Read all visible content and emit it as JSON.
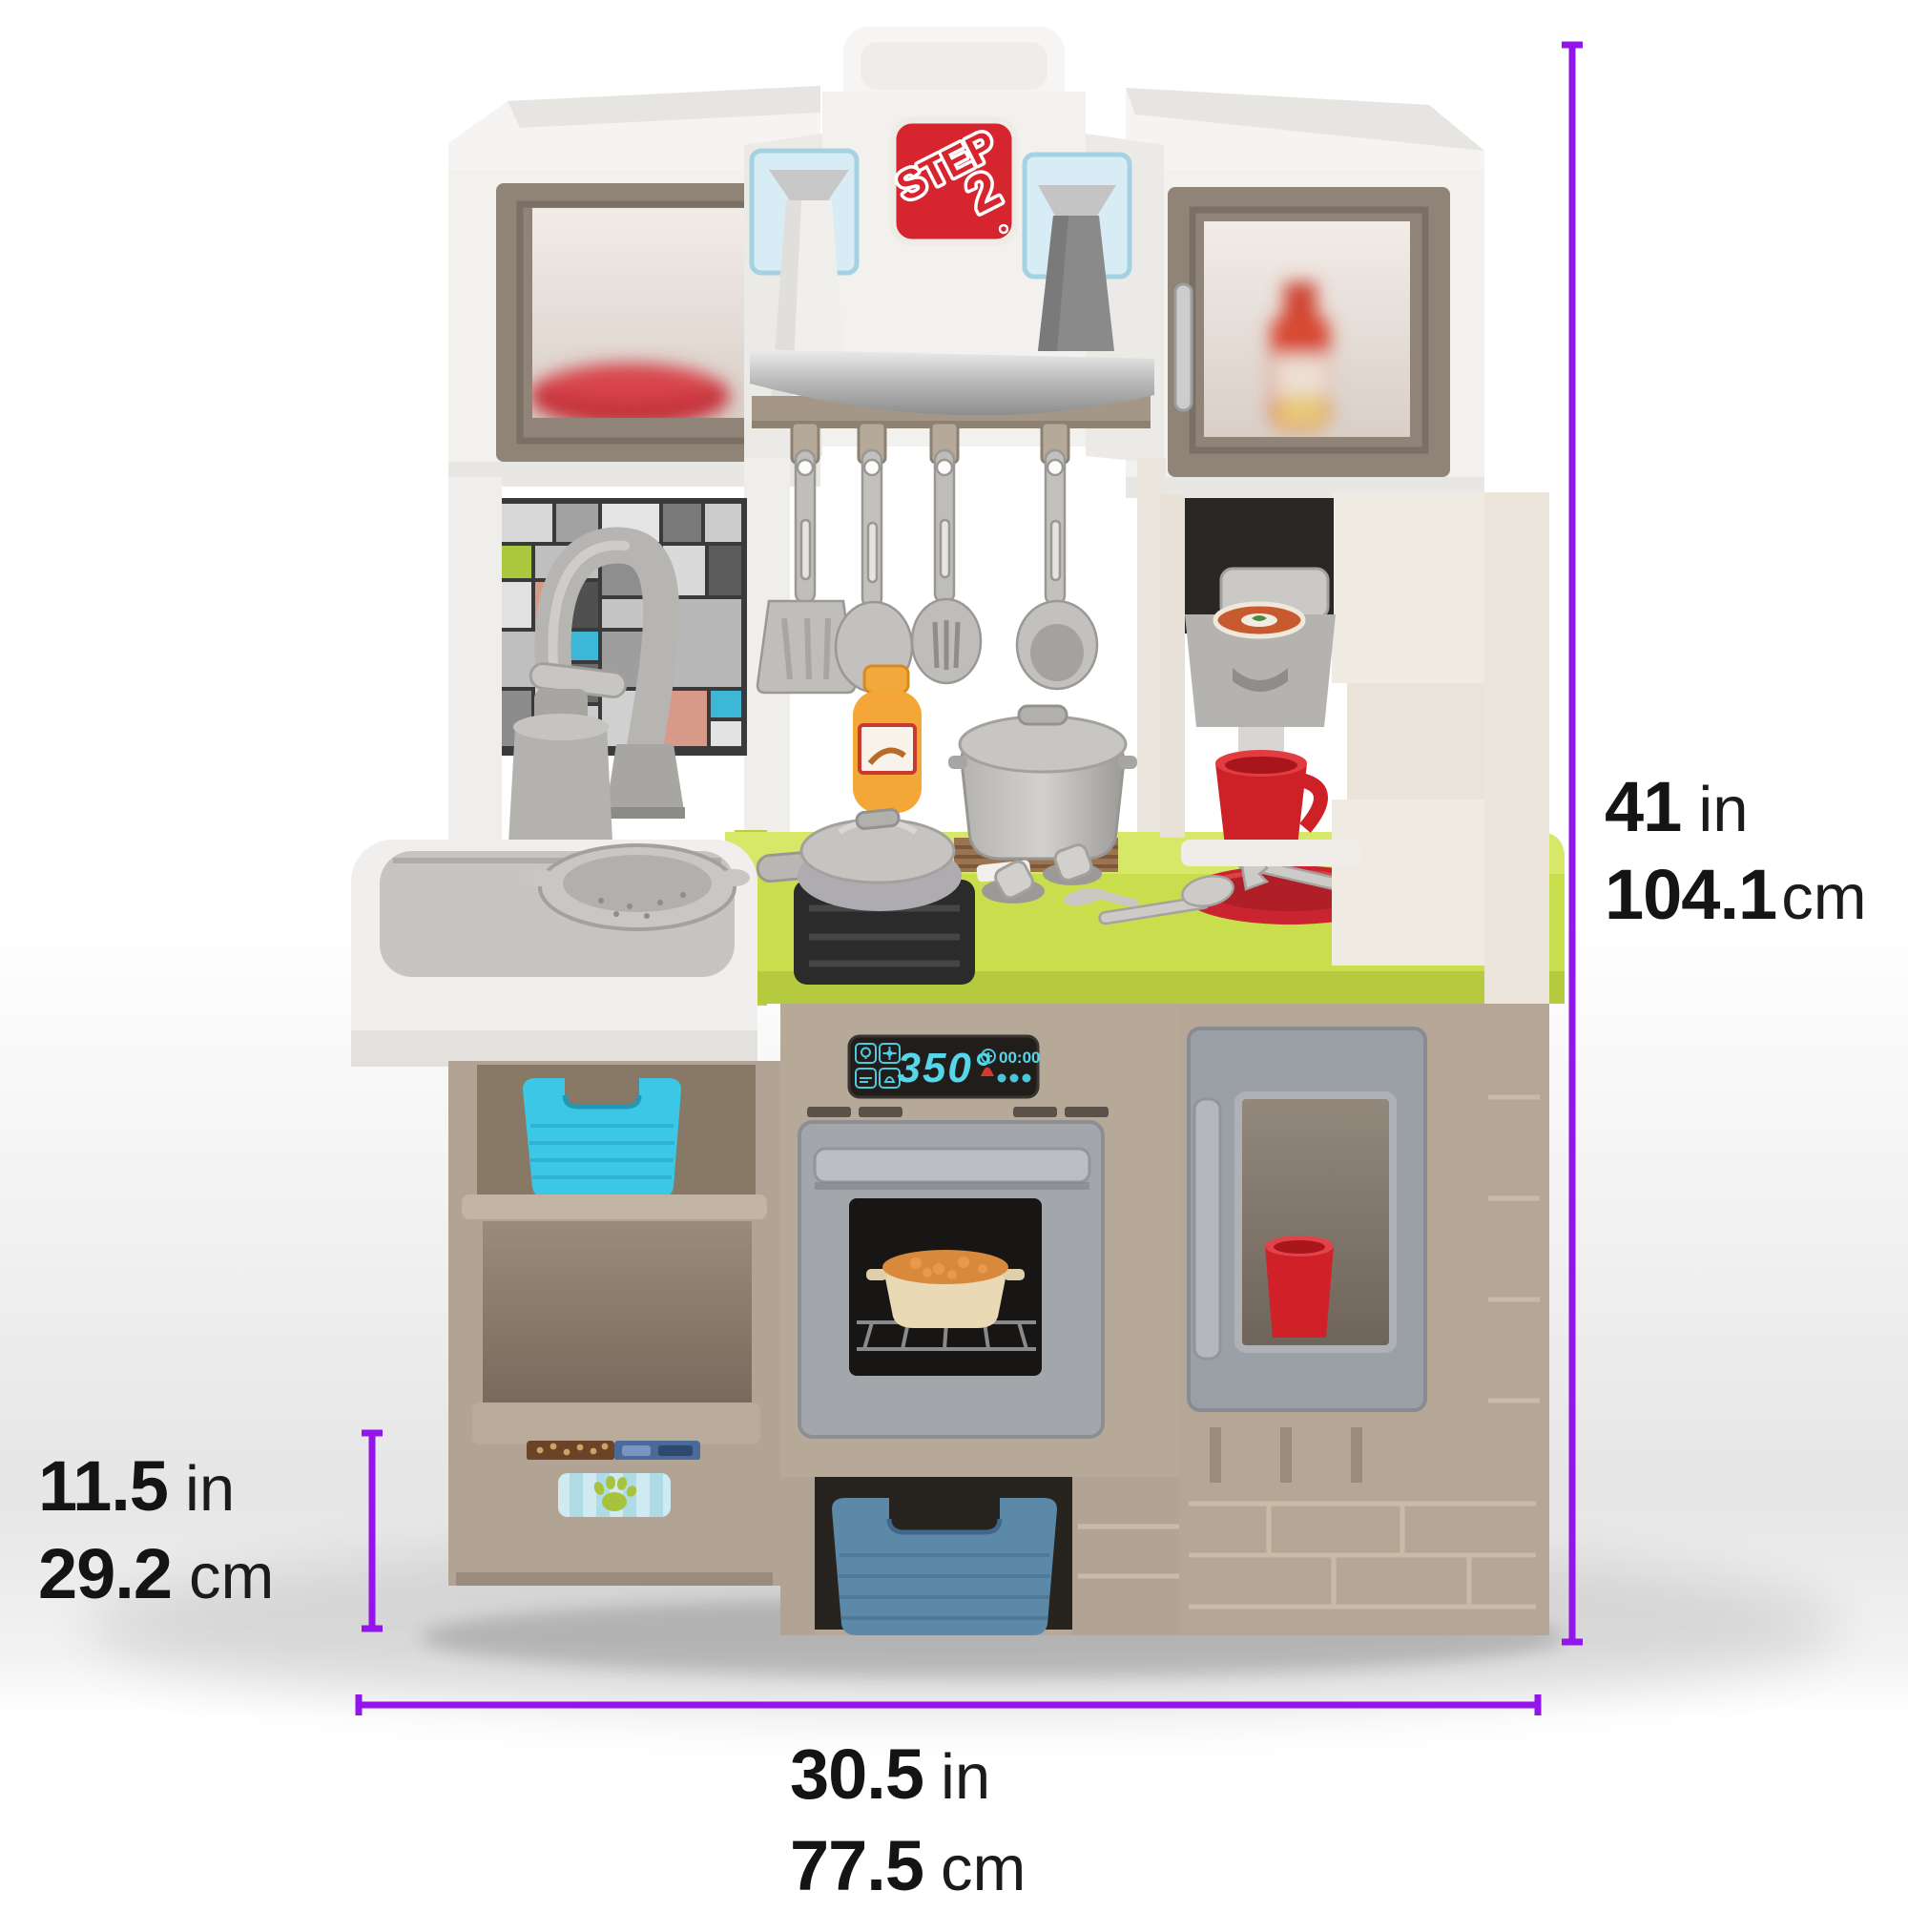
{
  "image": {
    "type": "product-dimension-photo",
    "subject": "toy play kitchen",
    "background": "#ffffff"
  },
  "brand": {
    "logo_line1": "STEP",
    "logo_line2": "2",
    "logo_bg_color": "#d6252e"
  },
  "kitchen": {
    "oven_display": {
      "temperature": "350°",
      "timer": "00:00"
    }
  },
  "annotations": {
    "accent_color": "#9414ec",
    "text_color": "#141414",
    "height": {
      "value_in": "41",
      "unit_in": "in",
      "value_cm": "104.1",
      "unit_cm": "cm"
    },
    "shelf_height": {
      "value_in": "11.5",
      "unit_in": "in",
      "value_cm": "29.2",
      "unit_cm": "cm"
    },
    "width": {
      "value_in": "30.5",
      "unit_in": "in",
      "value_cm": "77.5",
      "unit_cm": "cm"
    }
  },
  "palette": {
    "counter_green": "#c8de4c",
    "base_taupe": "#b3a595",
    "teal_bin": "#3cc7e6",
    "steel_blue_bin": "#5d89a8",
    "red_accent": "#ce2127",
    "display_cyan": "#56d7e9",
    "oven_gray": "#a3a7ac",
    "white_plastic": "#f2f1ee"
  }
}
